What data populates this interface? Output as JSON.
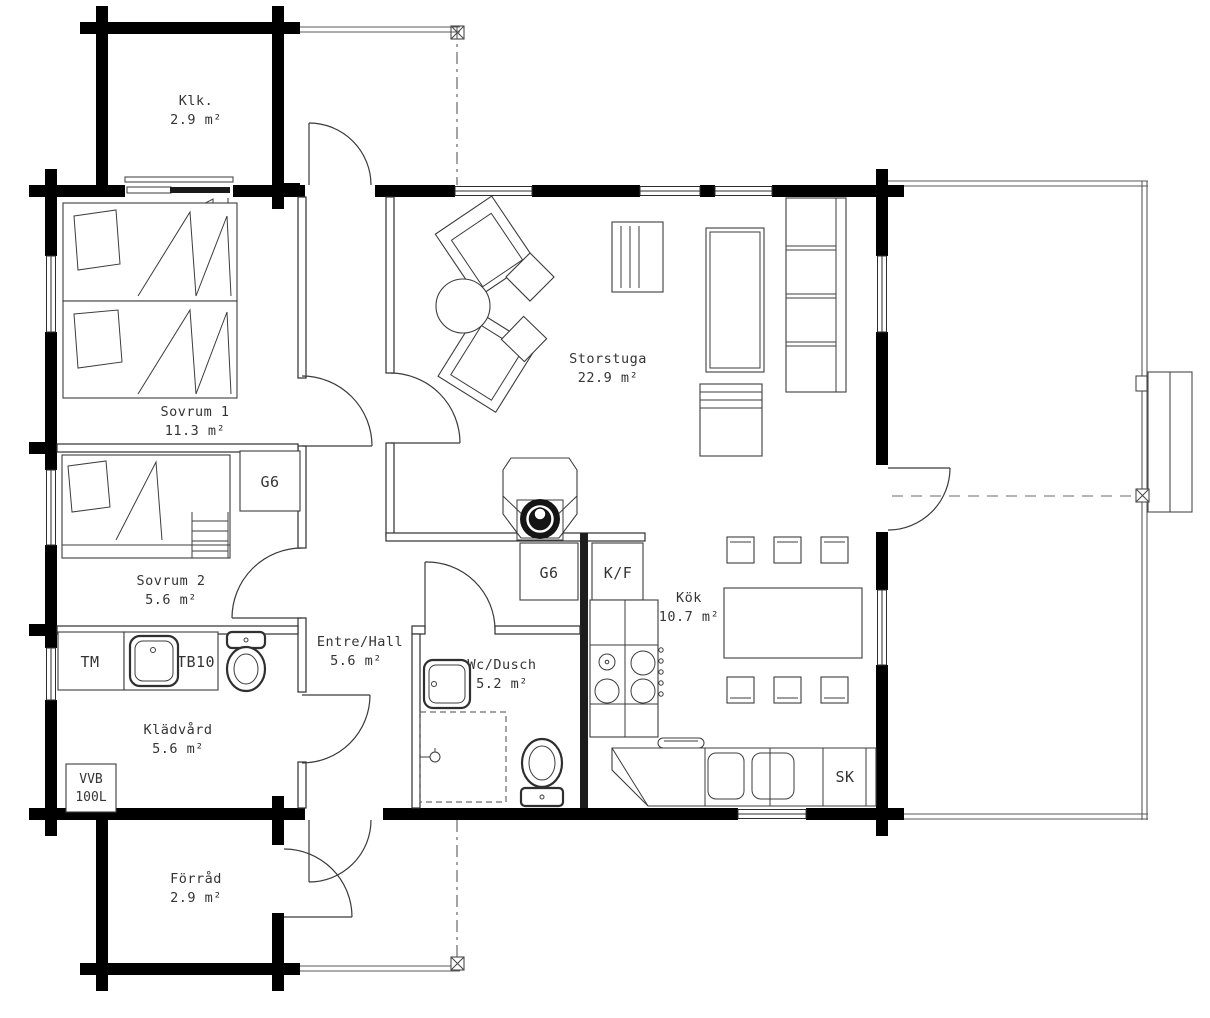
{
  "drawing": {
    "type": "floor-plan",
    "units": "m²"
  },
  "rooms": {
    "klk": {
      "name": "Klk.",
      "area": "2.9 m²"
    },
    "sovrum1": {
      "name": "Sovrum 1",
      "area": "11.3 m²"
    },
    "sovrum2": {
      "name": "Sovrum 2",
      "area": "5.6 m²"
    },
    "storstuga": {
      "name": "Storstuga",
      "area": "22.9 m²"
    },
    "kok": {
      "name": "Kök",
      "area": "10.7 m²"
    },
    "entre": {
      "name": "Entre/Hall",
      "area": "5.6 m²"
    },
    "wc": {
      "name": "Wc/Dusch",
      "area": "5.2 m²"
    },
    "kladvard": {
      "name": "Klädvård",
      "area": "5.6 m²"
    },
    "forrad": {
      "name": "Förråd",
      "area": "2.9 m²"
    }
  },
  "fixtures": {
    "wardrobe_bedroom": "G6",
    "wardrobe_hall": "G6",
    "fridge_freezer": "K/F",
    "washing_machine": "TM",
    "laundry_sink": "TB10",
    "water_heater_line1": "VVB",
    "water_heater_line2": "100L",
    "cleaning_cabinet": "SK"
  },
  "colors": {
    "walls": "#000000",
    "lines": "#3c3c3c",
    "background": "#ffffff"
  }
}
